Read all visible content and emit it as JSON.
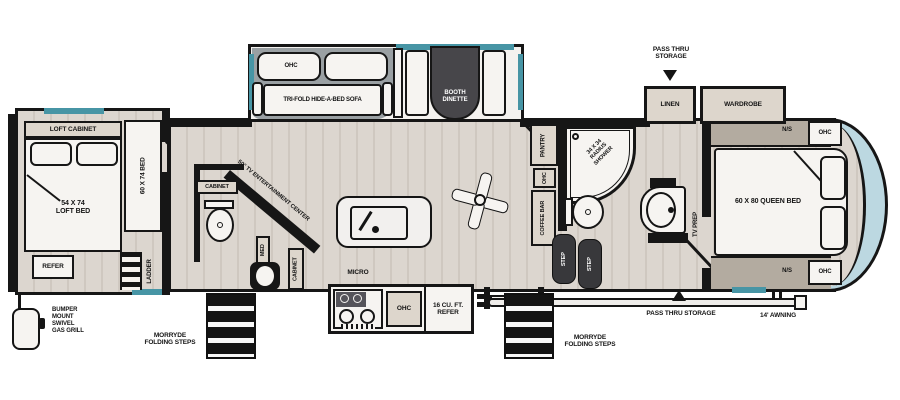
{
  "colors": {
    "wall": "#161616",
    "window_teal": "#4795a5",
    "front_cap_blue": "#bcd8e1",
    "floor_plank": "#d7d1ca",
    "label_bg": "#ddd6cc",
    "dark_fixture": "#47464a"
  },
  "labels": {
    "loft_cabinet": "LOFT CABINET",
    "loft_bed": "54 X 74\nLOFT BED",
    "garage_bed": "60 X 74\nBED",
    "refer_small": "REFER",
    "ladder": "LADDER",
    "gas_grill": "BUMPER\nMOUNT\nSWIVEL\nGAS GRILL",
    "morryde_steps": "MORRYDE\nFOLDING STEPS",
    "sofa": "TRI-FOLD HIDE-A-BED SOFA",
    "ohc": "OHC",
    "booth_dinette": "BOOTH\nDINETTE",
    "entertainment_center": "50\" TV ENTERTAINMENT CENTER",
    "cabinet": "CABINET",
    "med": "MED",
    "micro": "MICRO",
    "refer_large": "16 CU. FT.\nREFER",
    "pantry": "PANTRY",
    "coffee_bar": "COFFEE BAR",
    "shower": "34 X 34\nRADIUS\nSHOWER",
    "step": "STEP",
    "tv_prep": "TV PREP",
    "linen": "LINEN",
    "wardrobe": "WARDROBE",
    "pass_thru_top": "PASS THRU\nSTORAGE",
    "pass_thru_bottom": "PASS THRU STORAGE",
    "ns": "N/S",
    "queen_bed": "60 X 80  QUEEN BED",
    "awning": "14' AWNING"
  }
}
